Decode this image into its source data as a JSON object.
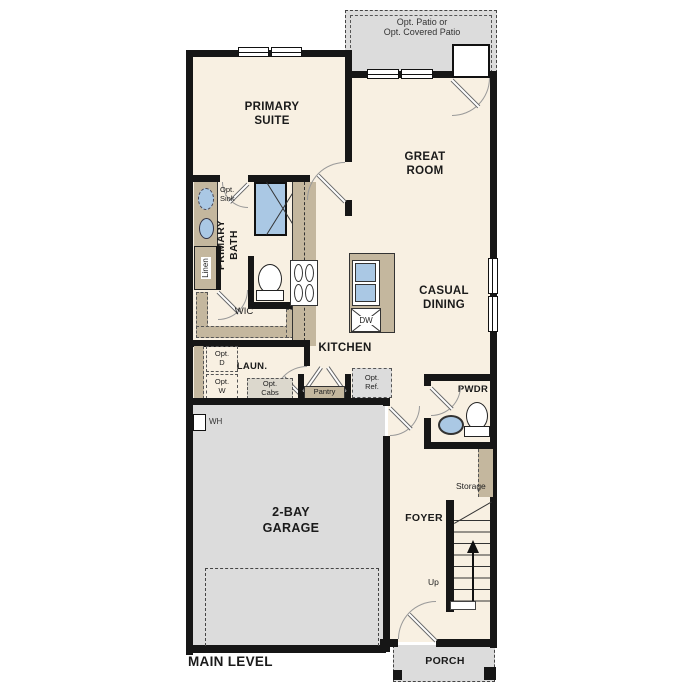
{
  "title": "MAIN LEVEL",
  "colors": {
    "floor": "#f8f0e2",
    "outdoor": "#dcdcdc",
    "counter": "#c4b79e",
    "water": "#aac8e4",
    "wall": "#161616"
  },
  "labels": {
    "patio": "Opt. Patio or\nOpt. Covered Patio",
    "primary_suite": "PRIMARY\nSUITE",
    "great_room": "GREAT\nROOM",
    "casual_dining": "CASUAL\nDINING",
    "kitchen": "KITCHEN",
    "primary_bath": "PRIMARY\nBATH",
    "opt_sink": "Opt.\nSink",
    "linen": "Linen",
    "wic": "WIC",
    "laundry": "LAUN.",
    "opt_d": "Opt.\nD",
    "opt_w": "Opt.\nW",
    "opt_cabs": "Opt.\nCabs",
    "pantry": "Pantry",
    "opt_ref": "Opt.\nRef.",
    "dw": "DW",
    "pwdr": "PWDR",
    "wh": "WH",
    "garage": "2-BAY\nGARAGE",
    "foyer": "FOYER",
    "storage": "Storage",
    "up": "Up",
    "porch": "PORCH",
    "main_level": "MAIN LEVEL"
  }
}
